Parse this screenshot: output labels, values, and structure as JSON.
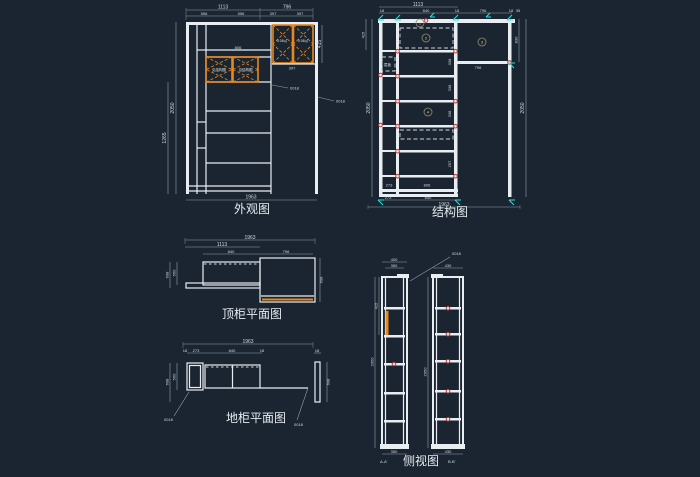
{
  "app": {
    "type": "cad-drawing-viewport",
    "colors": {
      "background": "#1b2531",
      "line": "#e8edf1",
      "dimension": "#8fa0ac",
      "dimension_text": "#cfd9df",
      "door_orange": "#e8891f",
      "marker_cyan": "#27e2e2",
      "marker_red": "#c23535"
    }
  },
  "views": {
    "waiguan": {
      "title": "外观图",
      "dims": {
        "top_left": "1113",
        "top_right": "796",
        "sub": [
          "556",
          "556",
          "397",
          "397"
        ],
        "shelf": "806",
        "under_door": "397",
        "left_full": "2050",
        "left_partial": "1265",
        "door_height": "415",
        "bottom_total": "1963"
      },
      "door_small_label": "见结构图",
      "door_big_label": "0.08㎡",
      "leader1": "0018",
      "leader2": "0018"
    },
    "jiegou": {
      "title": "结构图",
      "dims": {
        "top_total": "1113",
        "top_sub": [
          "18",
          "840",
          "18",
          "796",
          "18",
          "35"
        ],
        "bottom_inner": [
          "273",
          "806"
        ],
        "bottom_mid": [
          "273",
          "840"
        ],
        "bottom_total": "1963",
        "left_full": "2050",
        "left_partial": "415",
        "right_partial": "830",
        "right_full": "2050",
        "right_section": "796",
        "cells": [
          "338",
          "338",
          "338",
          "297"
        ]
      },
      "callouts": [
        "1",
        "2",
        "3",
        "4"
      ],
      "tiny_label": "层板"
    },
    "dinggui": {
      "title": "顶柜平面图",
      "dims": {
        "total": "1963",
        "left_w": "1113",
        "sub_left": "840",
        "sub_right": "796",
        "depth_a": "608",
        "depth_b": "560",
        "depth_right": "608"
      }
    },
    "digui": {
      "title": "地柜平面图",
      "dims": {
        "total": "1963",
        "sub": [
          "18",
          "273",
          "840",
          "18"
        ],
        "strip": "18",
        "depth_a": "608",
        "depth_b": "560",
        "depth_right": "608"
      },
      "leader1": "0018",
      "leader2": "0018"
    },
    "ceshi": {
      "title": "侧视图",
      "section_a": "A-A'",
      "section_b": "B-B'",
      "dims": {
        "a_top": "400",
        "a_top2": "350",
        "b_top": "430",
        "a_height": "2050",
        "a_partial": "415",
        "mid_height": "2050",
        "a_bottom": "350",
        "b_bottom": "430"
      },
      "leader": "0018"
    }
  }
}
